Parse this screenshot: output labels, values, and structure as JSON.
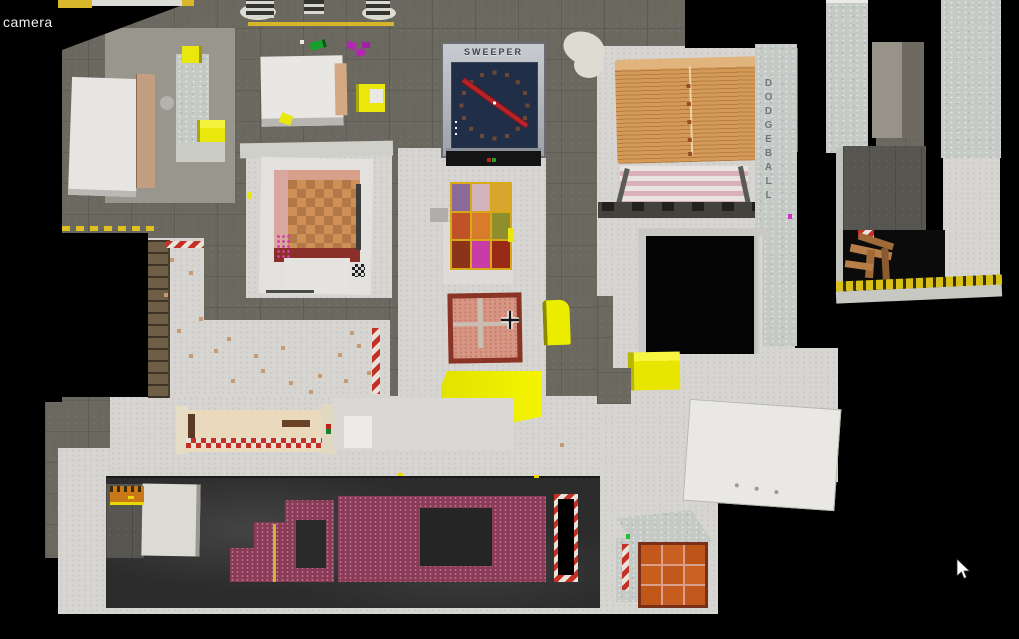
{
  "hud": {
    "camera_label": "camera"
  },
  "signs": {
    "sweeper": "SWEEPER",
    "dodgeball": "DODGEBALL"
  },
  "cursor": {
    "icon": "arrow-cursor"
  },
  "crosshair": {
    "icon": "plus-crosshair"
  },
  "colors": {
    "void": "#000000",
    "concrete_wall": "#6b6860",
    "floor_light": "#d6d5d1",
    "accent_yellow": "#e9e70b",
    "hazard_red": "#c23026",
    "hazard_white": "#e8e2d8",
    "sweeper_panel_navy": "#212e47",
    "sweeper_arm_red": "#b6242a",
    "dresser_wood": "#d59a58",
    "radiator_pink": "#dab0bc",
    "crate_salmon": "#d89584",
    "maroon_brick": "#8b3a58",
    "chessboard_light": "#cf9057",
    "chessboard_dark": "#b27848",
    "quilt_gold": "#d8a818"
  },
  "quilt_colors": [
    "#8a6a9a",
    "#d2b2bc",
    "#d8a62c",
    "#c05228",
    "#d87c2c",
    "#8e8e2e",
    "#8c3418",
    "#c83ca8",
    "#9a2a18"
  ]
}
